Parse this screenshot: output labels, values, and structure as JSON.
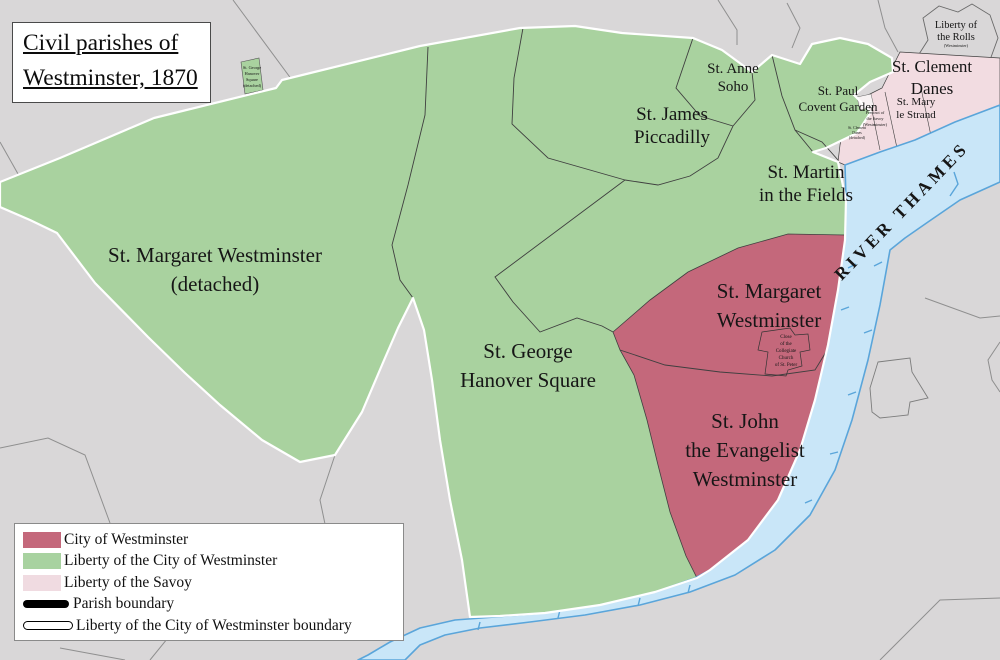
{
  "title": {
    "line1": "Civil parishes of",
    "line2": "Westminster, 1870"
  },
  "legend": {
    "items": [
      {
        "label": "City of Westminster",
        "swatch": "area",
        "color": "#c4687b"
      },
      {
        "label": "Liberty of the City of Westminster",
        "swatch": "area",
        "color": "#a8d2a0"
      },
      {
        "label": "Liberty of the Savoy",
        "swatch": "area",
        "color": "#f0dbe1"
      },
      {
        "label": "Parish boundary",
        "swatch": "thick-black-line",
        "color": "#000000"
      },
      {
        "label": "Liberty of the City of Westminster boundary",
        "swatch": "white-outline-line",
        "color": "#ffffff"
      }
    ]
  },
  "river": {
    "label": "RIVER THAMES"
  },
  "labels": {
    "st_margaret_detached": {
      "line1": "St. Margaret Westminster",
      "line2": "(detached)"
    },
    "st_george": {
      "line1": "St. George",
      "line2": "Hanover Square"
    },
    "st_james": {
      "line1": "St. James",
      "line2": "Piccadilly"
    },
    "st_anne": {
      "line1": "St. Anne",
      "line2": "Soho"
    },
    "st_martin": {
      "line1": "St. Martin",
      "line2": "in the Fields"
    },
    "st_paul": {
      "line1": "St. Paul",
      "line2": "Covent Garden"
    },
    "st_clement": {
      "line1": "St. Clement",
      "line2": "Danes"
    },
    "st_mary": {
      "line1": "St. Mary",
      "line2": "le Strand"
    },
    "liberty_rolls": {
      "line1": "Liberty of",
      "line2": "the Rolls",
      "line3": "(Westminster)"
    },
    "st_margaret": {
      "line1": "St. Margaret",
      "line2": "Westminster"
    },
    "st_john": {
      "line1": "St. John",
      "line2": "the Evangelist",
      "line3": "Westminster"
    },
    "close_collegiate": {
      "line1": "Close",
      "line2": "of the",
      "line3": "Collegiate",
      "line4": "Church",
      "line5": "of St. Peter"
    },
    "st_george_detached": {
      "line1": "St. George",
      "line2": "Hanover",
      "line3": "Square",
      "line4": "(detached)"
    },
    "precinct_savoy": {
      "line1": "Precinct of",
      "line2": "the Savoy",
      "line3": "(Westminster)"
    },
    "st_clement_detached": {
      "line1": "St. Clement",
      "line2": "Danes",
      "line3": "(detached)"
    }
  },
  "colors": {
    "background": "#d9d7d8",
    "liberty_green": "#a9d29f",
    "city_red": "#c4687b",
    "savoy_pink": "#f2dce1",
    "river_fill": "#c9e6f8",
    "river_stroke": "#5aa5da",
    "river_text": "#2176c0",
    "parish_boundary": "#3f3f3f",
    "liberty_outline": "#ffffff",
    "grey_line": "#8f8f8f"
  }
}
